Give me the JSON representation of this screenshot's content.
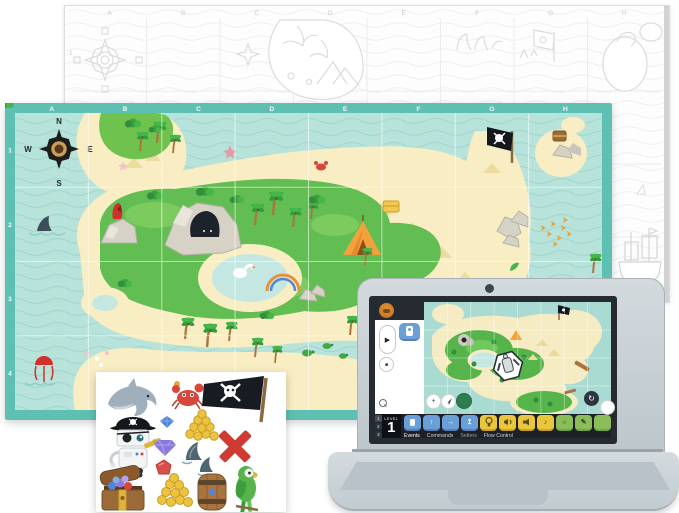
{
  "outline_map": {
    "columns": [
      "A",
      "B",
      "C",
      "D",
      "E",
      "F",
      "G",
      "H"
    ],
    "rows": [
      "1"
    ]
  },
  "color_map": {
    "columns": [
      "A",
      "B",
      "C",
      "D",
      "E",
      "F",
      "G",
      "H"
    ],
    "rows": [
      "1",
      "2",
      "3",
      "4"
    ],
    "compass": {
      "north": "N",
      "east": "E",
      "south": "S",
      "west": "W"
    }
  },
  "laptop": {
    "screen": {
      "level_label": "LEVEL",
      "level_value": "1",
      "level_rows": [
        "1",
        "2",
        "3"
      ],
      "tabs": [
        {
          "label": "Events",
          "active": true
        },
        {
          "label": "Commands",
          "active": false
        },
        {
          "label": "Setters",
          "active": false
        },
        {
          "label": "Flow Control",
          "active": false
        }
      ]
    }
  },
  "stickers": {
    "items": [
      "dolphin",
      "crab",
      "pirate-flag",
      "robot-pirate",
      "blue-gem",
      "gold-coin-pile",
      "purple-diamond",
      "shark-fins",
      "red-x",
      "red-gem",
      "treasure-chest",
      "gold-coins",
      "wooden-barrel",
      "parrot"
    ]
  },
  "icons": {
    "play": "▶",
    "stop": "■",
    "reset": "↻",
    "zoom_in": "+",
    "note": "♪",
    "sun": "☼",
    "pencil": "✎",
    "arrow_up": "↑",
    "arrow_right": "→",
    "arrow_lift": "↥"
  },
  "colors": {
    "map_band": "#5ec0b2",
    "water": "#b7e3db",
    "sand": "#f8edc3",
    "island_green": "#62bd52",
    "block_blue": "#6b9fd8",
    "block_yellow": "#eac63f",
    "block_green": "#8bbd5a",
    "laptop_body": "#ccd4d9",
    "screen_dark": "#262b32"
  }
}
